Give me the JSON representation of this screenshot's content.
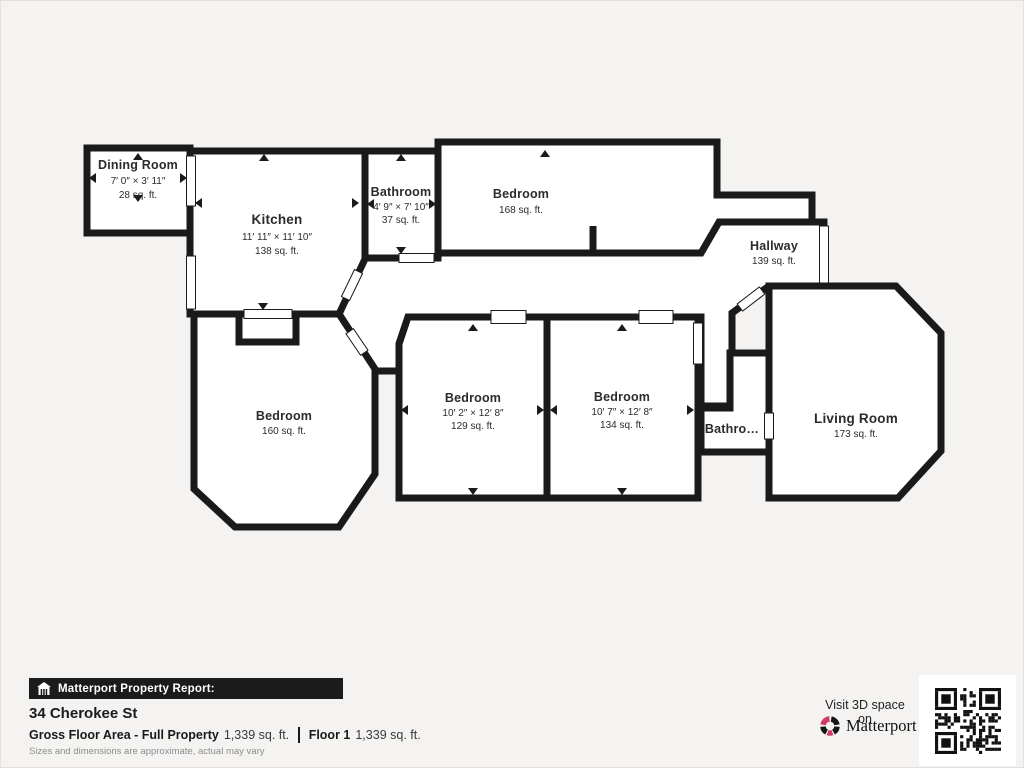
{
  "plan": {
    "rooms": [
      {
        "id": "dining-room",
        "name": "Dining Room",
        "dims": "7′ 0″ × 3′ 11″",
        "area": "28 sq. ft."
      },
      {
        "id": "kitchen",
        "name": "Kitchen",
        "dims": "11′ 11″ × 11′ 10″",
        "area": "138 sq. ft."
      },
      {
        "id": "bathroom",
        "name": "Bathroom",
        "dims": "4′ 9″ × 7′ 10″",
        "area": "37 sq. ft."
      },
      {
        "id": "bedroom-top",
        "name": "Bedroom",
        "area": "168 sq. ft."
      },
      {
        "id": "hallway",
        "name": "Hallway",
        "area": "139 sq. ft."
      },
      {
        "id": "bedroom-left",
        "name": "Bedroom",
        "area": "160 sq. ft."
      },
      {
        "id": "bedroom-mid-left",
        "name": "Bedroom",
        "dims": "10′ 2″ × 12′ 8″",
        "area": "129 sq. ft."
      },
      {
        "id": "bedroom-mid-right",
        "name": "Bedroom",
        "dims": "10′ 7″ × 12′ 8″",
        "area": "134 sq. ft."
      },
      {
        "id": "bathroom-small",
        "name": "Bathro…"
      },
      {
        "id": "living-room",
        "name": "Living Room",
        "area": "173 sq. ft."
      }
    ]
  },
  "footer": {
    "report_label": "Matterport Property Report:",
    "address": "34 Cherokee St",
    "gross_label": "Gross Floor Area - Full Property",
    "gross_value": "1,339 sq. ft.",
    "floor_label": "Floor 1",
    "floor_value": "1,339 sq. ft.",
    "disclaimer": "Sizes and dimensions are approximate, actual may vary",
    "visit_label": "Visit 3D space on",
    "brand": "Matterport"
  },
  "colors": {
    "wall": "#1a1a1a",
    "room_fill": "#ffffff",
    "background": "#f4f3f1",
    "accent_pink": "#cf3a68"
  }
}
